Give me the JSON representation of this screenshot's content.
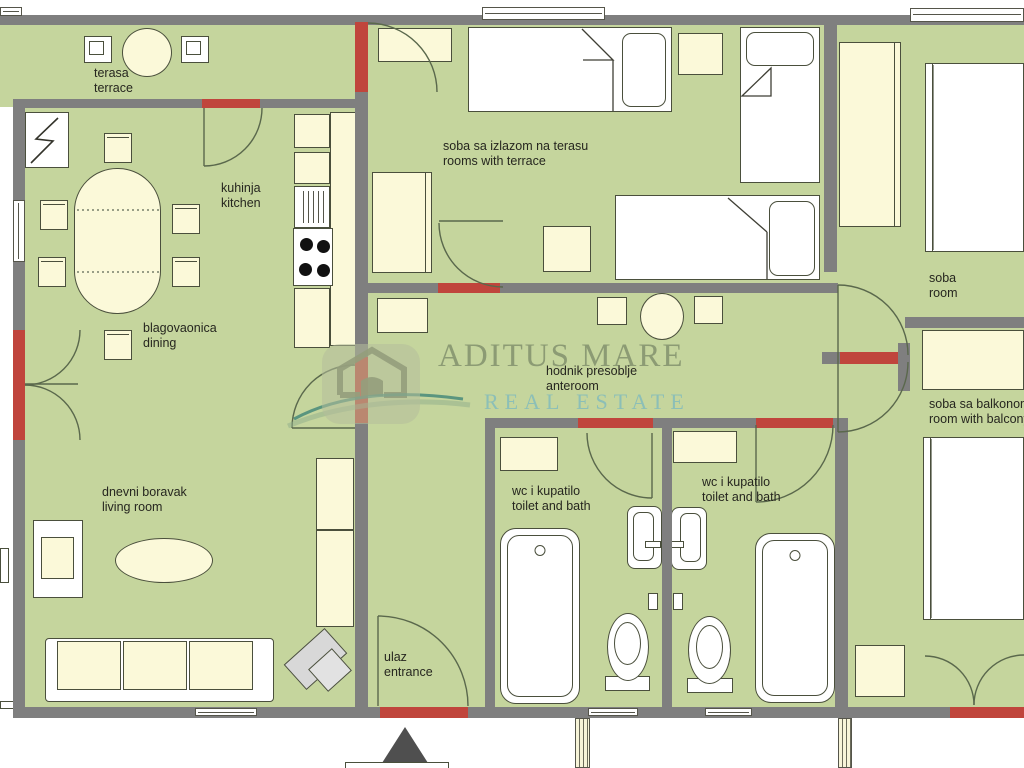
{
  "watermark": {
    "brand": "ADITUS MARE",
    "tagline": "REAL ESTATE"
  },
  "rooms": {
    "terrace": {
      "hr": "terasa",
      "en": "terrace"
    },
    "kitchen": {
      "hr": "kuhinja",
      "en": "kitchen"
    },
    "bedroom_terrace": {
      "hr": "soba sa izlazom na terasu",
      "en": "rooms with terrace"
    },
    "room": {
      "hr": "soba",
      "en": "room"
    },
    "dining": {
      "hr": "blagovaonica",
      "en": "dining"
    },
    "anteroom": {
      "hr": "hodnik presoblje",
      "en": "anteroom"
    },
    "room_balcony": {
      "hr": "soba sa balkonom",
      "en": "room with balcony"
    },
    "living": {
      "hr": "dnevni boravak",
      "en": "living room"
    },
    "bath1": {
      "hr": "wc i kupatilo",
      "en": "toilet and bath"
    },
    "bath2": {
      "hr": "wc i kupatilo",
      "en": "toilet and bath"
    },
    "entrance": {
      "hr": "ulaz",
      "en": "entrance"
    }
  },
  "colors": {
    "floor": "#c5d59d",
    "wall": "#7f7f7f",
    "door_red": "#c0453c",
    "furniture": "#fbf9d9",
    "outline": "#4a4f3c",
    "arc": "#5a684c",
    "text": "#26261f",
    "watermark_brand": "rgba(105,120,90,0.62)",
    "watermark_tagline": "rgba(125,185,190,0.8)"
  }
}
